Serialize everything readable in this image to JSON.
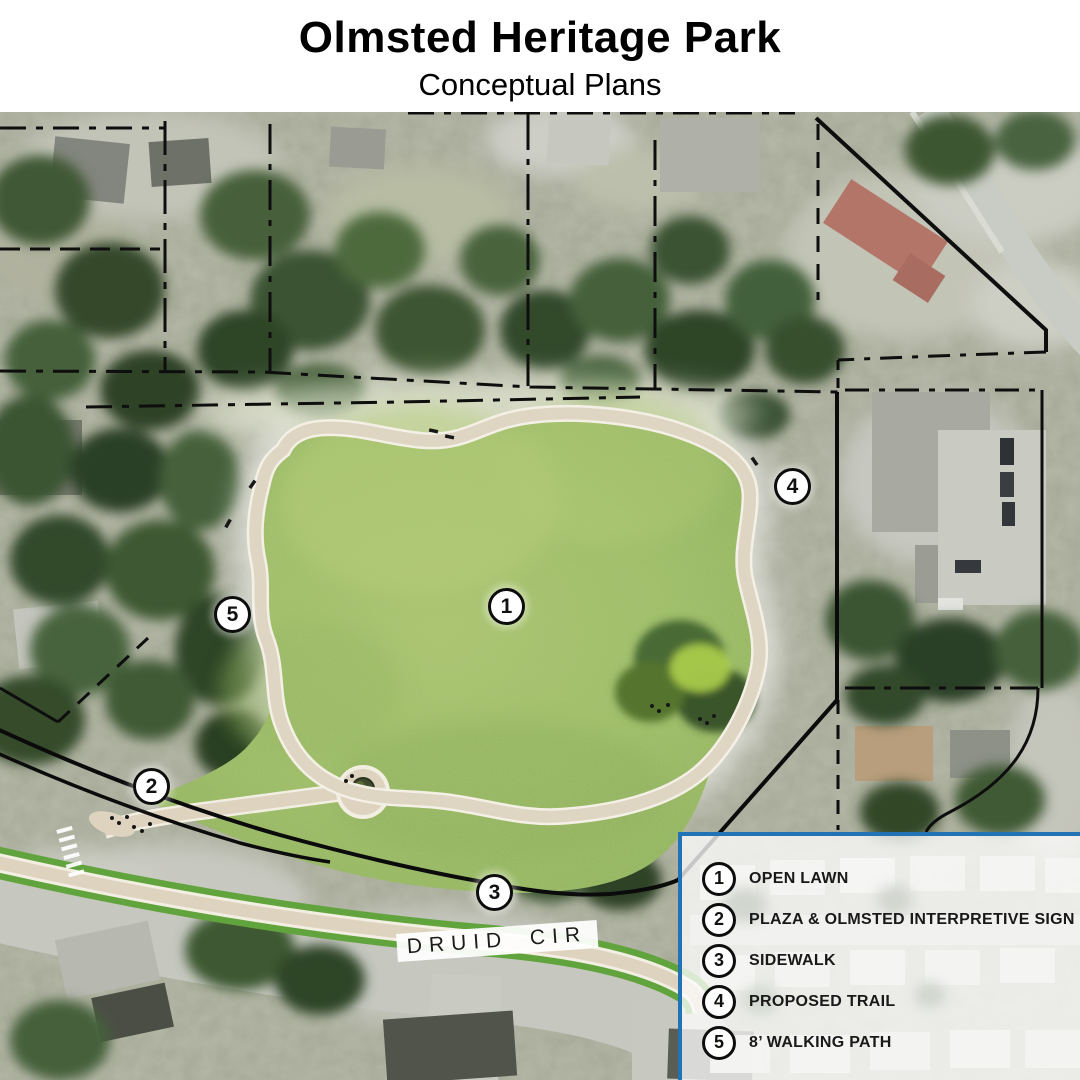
{
  "header": {
    "title": "Olmsted Heritage Park",
    "subtitle": "Conceptual Plans"
  },
  "map": {
    "street_label": "DRUID CIR",
    "markers": [
      {
        "number": "1",
        "x": 507,
        "y": 607
      },
      {
        "number": "2",
        "x": 152,
        "y": 787
      },
      {
        "number": "3",
        "x": 495,
        "y": 893
      },
      {
        "number": "4",
        "x": 793,
        "y": 487
      },
      {
        "number": "5",
        "x": 233,
        "y": 615
      }
    ]
  },
  "legend": {
    "items": [
      {
        "number": "1",
        "label": "OPEN LAWN"
      },
      {
        "number": "2",
        "label": "PLAZA & OLMSTED INTERPRETIVE SIGN"
      },
      {
        "number": "3",
        "label": "SIDEWALK"
      },
      {
        "number": "4",
        "label": "PROPOSED TRAIL"
      },
      {
        "number": "5",
        "label": "8’ WALKING PATH"
      }
    ]
  },
  "colors": {
    "legend_border": "#2273b6",
    "lawn_green": "#9cbd62",
    "path_beige": "#ddd3bf",
    "roadside_green": "#61a33c",
    "trail_line": "#0b0b0b"
  }
}
